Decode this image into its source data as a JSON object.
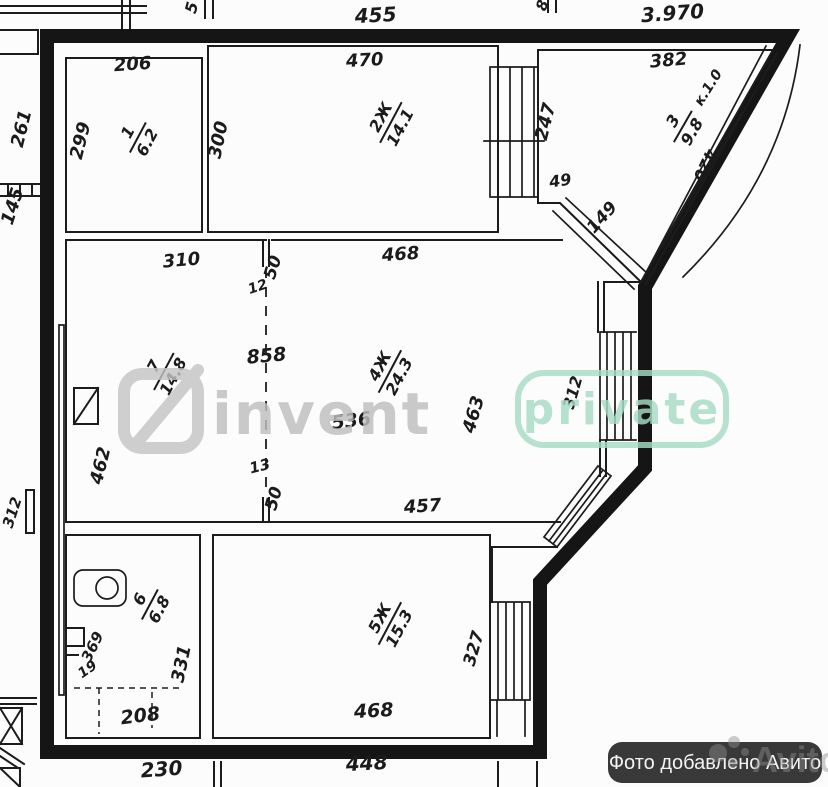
{
  "watermark": {
    "brand": "invent",
    "tag": "private"
  },
  "avito": {
    "badge_text": "Фото добавлено Авито",
    "logo_text": "Avito"
  },
  "plan": {
    "rooms": [
      {
        "number": "1",
        "area": "6.2"
      },
      {
        "number": "2Ж",
        "area": "14.1"
      },
      {
        "number": "3",
        "area": "9.8"
      },
      {
        "number": "4Ж",
        "area": "24.3"
      },
      {
        "number": "5Ж",
        "area": "15.3"
      },
      {
        "number": "6",
        "area": "6.8"
      },
      {
        "number": "7",
        "area": "14.8"
      }
    ],
    "dims": {
      "d455": "455",
      "d397": "3.970",
      "d5": "5",
      "d8": "8",
      "d261": "261",
      "d145": "145",
      "d312_out": "312",
      "d206": "206",
      "d299": "299",
      "d470": "470",
      "d300": "300",
      "d247": "247",
      "d382": "382",
      "k10": "к.1.0",
      "d420": "420",
      "d49": "49",
      "d149": "149",
      "d310": "310",
      "d462": "462",
      "d50_top": "50",
      "d12": "12",
      "d858": "858",
      "d536": "536",
      "d463": "463",
      "d468_top": "468",
      "d312_win": "312",
      "d457": "457",
      "d13": "13",
      "d50_bottom": "50",
      "d327": "327",
      "d468_bottom": "468",
      "d369": "369",
      "d19": "19",
      "d331": "331",
      "d208": "208",
      "d230": "230",
      "d448": "448"
    }
  }
}
